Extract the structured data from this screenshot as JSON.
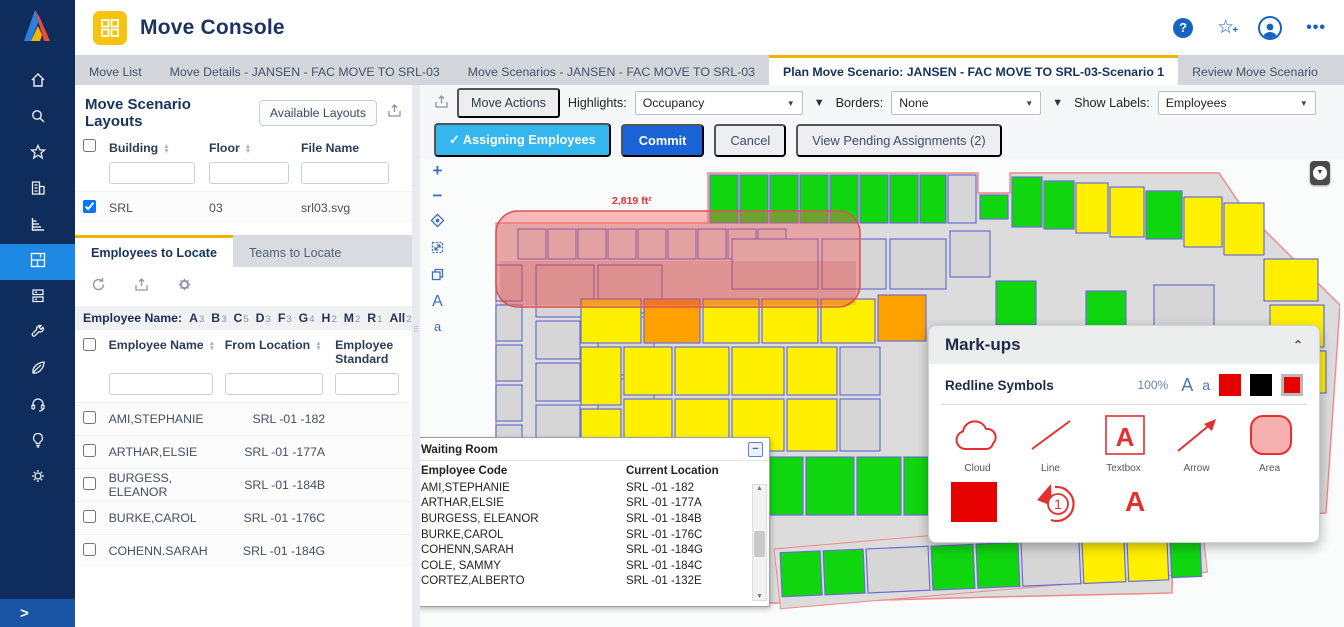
{
  "header": {
    "title": "Move Console"
  },
  "tabs": [
    {
      "label": "Move List",
      "active": false
    },
    {
      "label": "Move Details - JANSEN - FAC MOVE TO SRL-03",
      "active": false
    },
    {
      "label": "Move Scenarios - JANSEN - FAC MOVE TO SRL-03",
      "active": false
    },
    {
      "label": "Plan Move Scenario: JANSEN - FAC MOVE TO SRL-03-Scenario 1",
      "active": true
    },
    {
      "label": "Review Move Scenario",
      "active": false
    }
  ],
  "layouts": {
    "title": "Move Scenario Layouts",
    "available_button": "Available Layouts",
    "cols": {
      "building": "Building",
      "floor": "Floor",
      "file": "File Name"
    },
    "row": {
      "building": "SRL",
      "floor": "03",
      "file": "srl03.svg",
      "checked": true
    }
  },
  "locate": {
    "employees_tab": "Employees to Locate",
    "teams_tab": "Teams to Locate"
  },
  "letters": {
    "label": "Employee Name:",
    "items": [
      {
        "k": "A",
        "n": "3"
      },
      {
        "k": "B",
        "n": "3"
      },
      {
        "k": "C",
        "n": "5"
      },
      {
        "k": "D",
        "n": "3"
      },
      {
        "k": "F",
        "n": "3"
      },
      {
        "k": "G",
        "n": "4"
      },
      {
        "k": "H",
        "n": "2"
      },
      {
        "k": "M",
        "n": "2"
      },
      {
        "k": "R",
        "n": "1"
      },
      {
        "k": "All",
        "n": "26"
      }
    ]
  },
  "emp": {
    "cols": {
      "name": "Employee Name",
      "from": "From Location",
      "std": "Employee Standard"
    },
    "rows": [
      {
        "name": "AMI,STEPHANIE",
        "from": "SRL -01 -182"
      },
      {
        "name": "ARTHAR,ELSIE",
        "from": "SRL -01 -177A"
      },
      {
        "name": "BURGESS, ELEANOR",
        "from": "SRL -01 -184B"
      },
      {
        "name": "BURKE,CAROL",
        "from": "SRL -01 -176C"
      },
      {
        "name": "COHENN.SARAH",
        "from": "SRL -01 -184G"
      }
    ]
  },
  "mtb": {
    "move_actions": "Move Actions",
    "highlights_label": "Highlights:",
    "highlights_value": "Occupancy",
    "borders_label": "Borders:",
    "borders_value": "None",
    "labels_label": "Show Labels:",
    "labels_value": "Employees"
  },
  "act": {
    "assigning": "Assigning Employees",
    "commit": "Commit",
    "cancel": "Cancel",
    "pending": "View Pending Assignments (2)"
  },
  "map": {
    "area_label": "2,819 ft²"
  },
  "wr": {
    "title": "Waiting Room",
    "cols": {
      "code": "Employee Code",
      "loc": "Current Location"
    },
    "rows": [
      {
        "code": "AMI,STEPHANIE",
        "loc": "SRL -01 -182"
      },
      {
        "code": "ARTHAR,ELSIE",
        "loc": "SRL -01 -177A"
      },
      {
        "code": "BURGESS, ELEANOR",
        "loc": "SRL -01 -184B"
      },
      {
        "code": "BURKE,CAROL",
        "loc": "SRL -01 -176C"
      },
      {
        "code": "COHENN,SARAH",
        "loc": "SRL -01 -184G"
      },
      {
        "code": "COLE, SAMMY",
        "loc": "SRL -01 -184C"
      },
      {
        "code": "CORTEZ,ALBERTO",
        "loc": "SRL -01 -132E"
      }
    ]
  },
  "mk": {
    "title": "Mark-ups",
    "subtitle": "Redline Symbols",
    "zoom": "100%",
    "labels": [
      "Cloud",
      "Line",
      "Textbox",
      "Arrow",
      "Area"
    ],
    "swatches": [
      "#e60000",
      "#000000",
      "#e60000"
    ]
  },
  "icons": {
    "sidebar": [
      "home-icon",
      "search-icon",
      "star-icon",
      "building-icon",
      "chart-icon",
      "floorplan-icon",
      "server-icon",
      "wrench-icon",
      "leaf-icon",
      "headset-icon",
      "lightbulb-icon",
      "gear-icon"
    ],
    "header": [
      "help-icon",
      "favorite-add-icon",
      "user-avatar-icon",
      "more-icon"
    ]
  },
  "colors": {
    "accent_yellow": "#f0b400",
    "active_blue": "#1e88e5",
    "commit_blue": "#1a63d6",
    "cyan": "#33b7ee",
    "markup_red": "#e05252",
    "room_green": "#0fd60f",
    "room_yellow": "#fff000",
    "room_orange": "#ffa200"
  }
}
